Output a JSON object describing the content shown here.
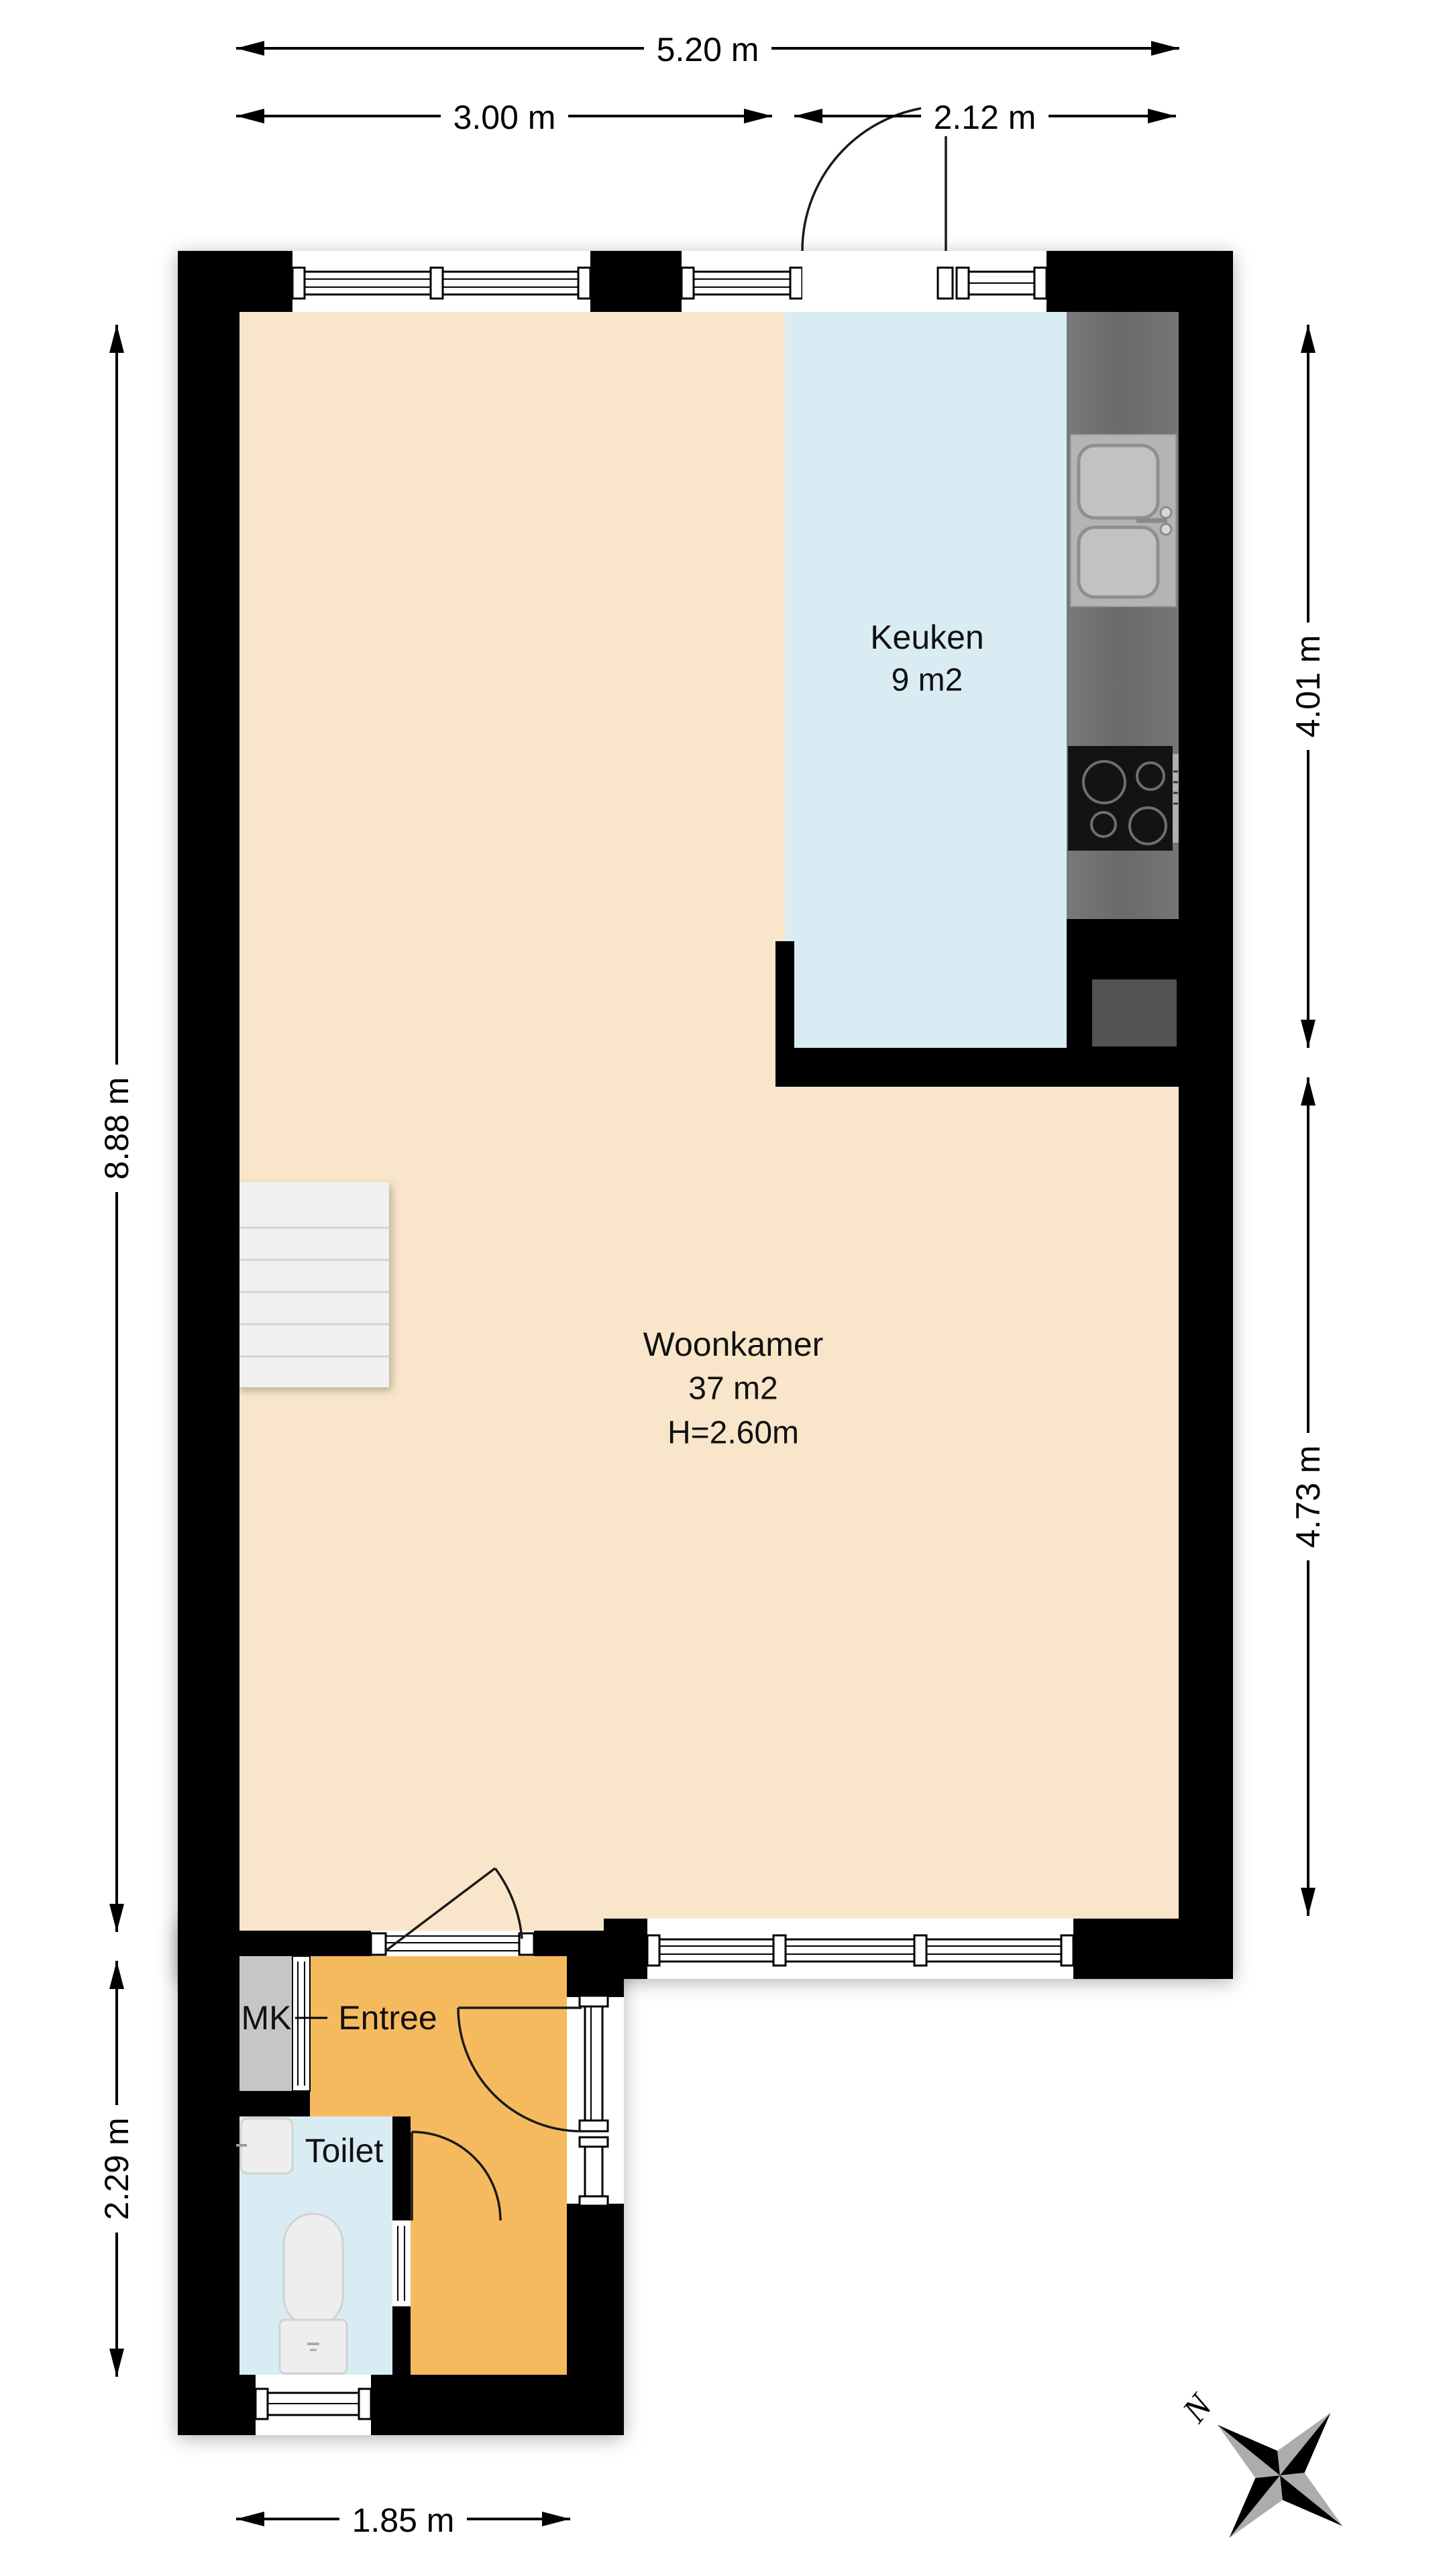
{
  "floorplan": {
    "rooms": {
      "keuken": {
        "label": "Keuken",
        "area": "9 m2"
      },
      "woonkamer": {
        "label": "Woonkamer",
        "area": "37 m2",
        "ceiling_height": "H=2.60m"
      },
      "entree": {
        "label": "Entree"
      },
      "toilet": {
        "label": "Toilet"
      },
      "mk": {
        "label": "MK"
      }
    },
    "dimensions": {
      "top_total": "5.20 m",
      "top_left": "3.00 m",
      "top_right": "2.12 m",
      "left_upper": "8.88 m",
      "left_lower": "2.29 m",
      "right_upper": "4.01 m",
      "right_lower": "4.73 m",
      "bottom": "1.85 m"
    },
    "compass": {
      "north_label": "N"
    },
    "colors": {
      "wall": "#000000",
      "woonkamer_floor": "#f9e6ca",
      "keuken_floor": "#d9ecf4",
      "toilet_floor": "#d9ecf4",
      "entree_floor": "#f6ba5e",
      "counter": "#6f6f72",
      "sink_panel": "#b4b4b6",
      "stove": "#131313",
      "mk_closet": "#c6c6c6",
      "shaft": "#535353",
      "stairs": "#f0f0f0",
      "compass_gray": "#acacac"
    }
  }
}
